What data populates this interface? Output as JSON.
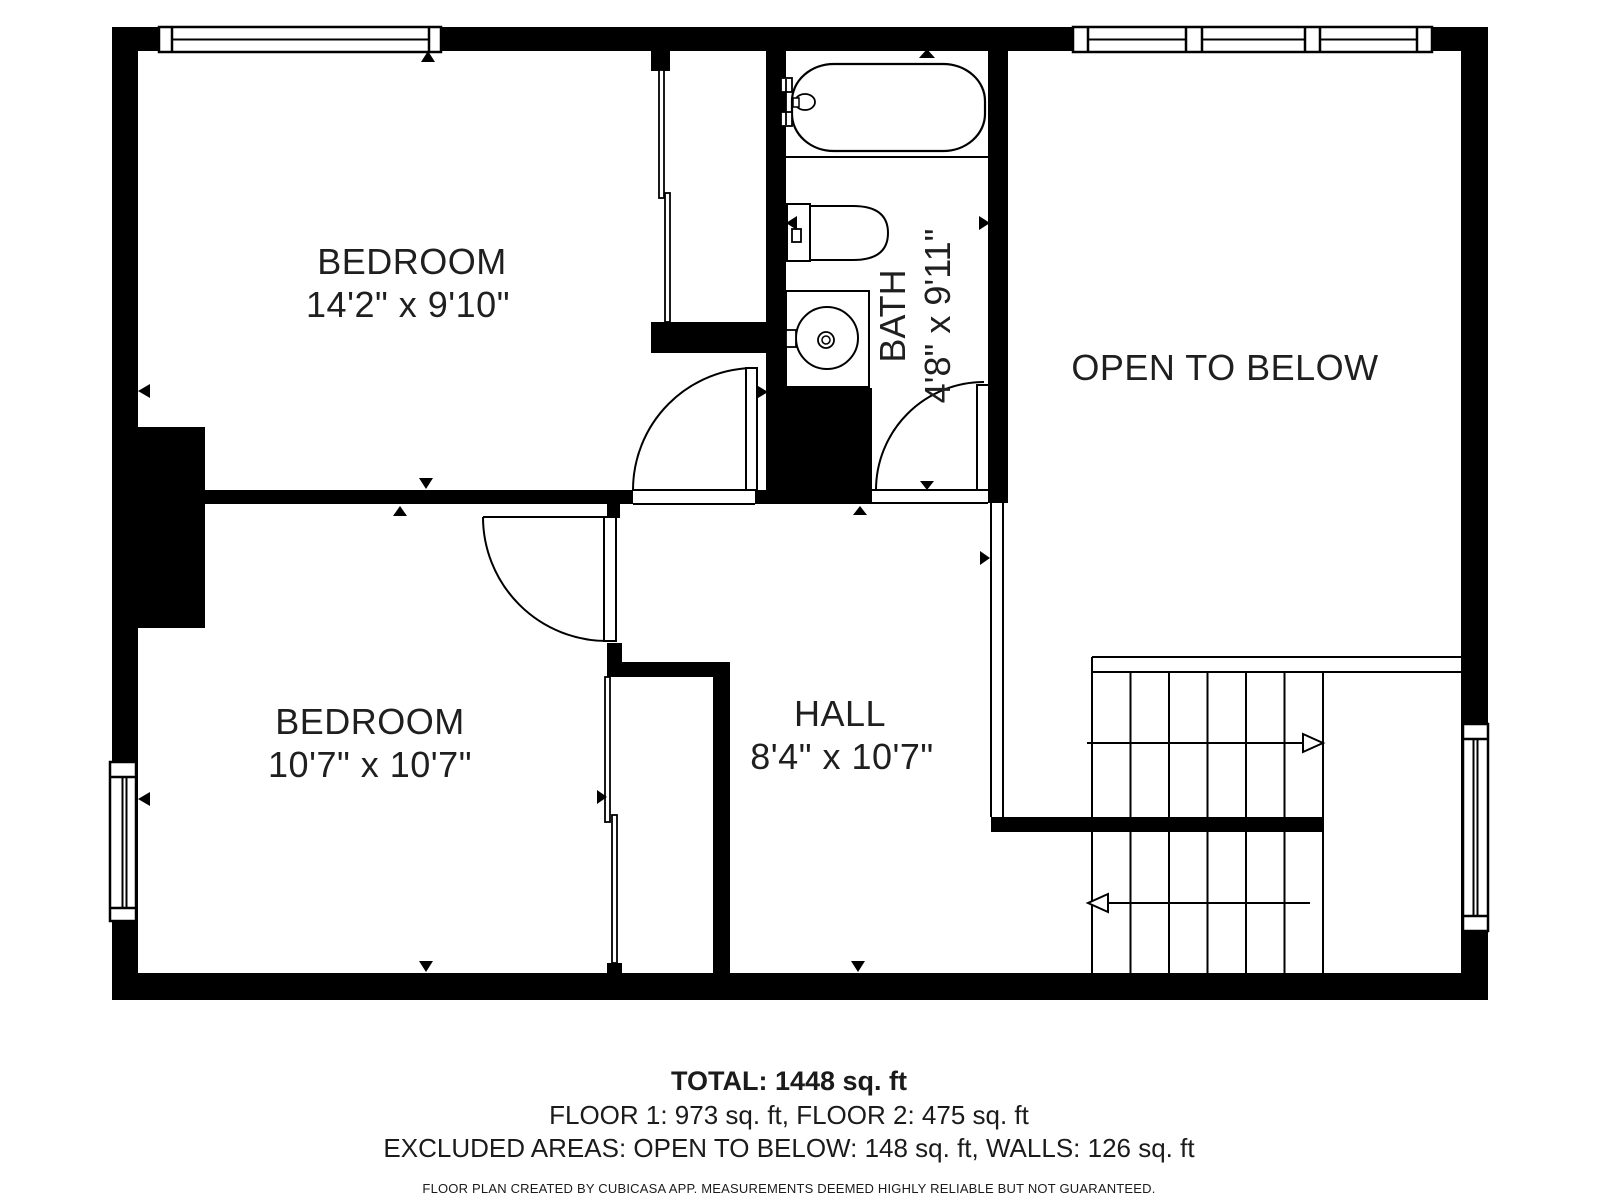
{
  "plan": {
    "type": "floor-plan",
    "floor": "Floor 2",
    "colors": {
      "wall": "#000000",
      "background": "#ffffff",
      "text": "#1f1f1f"
    },
    "rooms": {
      "bedroom1": {
        "name": "BEDROOM",
        "dims": "14'2\" x 9'10\""
      },
      "bedroom2": {
        "name": "BEDROOM",
        "dims": "10'7\" x 10'7\""
      },
      "bath": {
        "name": "BATH",
        "dims": "4'8\" x 9'11\""
      },
      "hall": {
        "name": "HALL",
        "dims": "8'4\" x 10'7\""
      },
      "open_to_below": {
        "name": "OPEN TO BELOW"
      }
    },
    "fixtures": [
      "bathtub",
      "toilet",
      "sink",
      "stairs"
    ],
    "stairs": {
      "flights": 2,
      "upper_arrow": "right",
      "lower_arrow": "left"
    }
  },
  "footer": {
    "total": "TOTAL: 1448 sq. ft",
    "floors": "FLOOR 1: 973 sq. ft, FLOOR 2: 475 sq. ft",
    "excluded": "EXCLUDED AREAS: OPEN TO BELOW: 148 sq. ft, WALLS: 126 sq. ft",
    "disclaimer": "FLOOR PLAN CREATED BY CUBICASA APP. MEASUREMENTS DEEMED HIGHLY RELIABLE BUT NOT GUARANTEED."
  }
}
